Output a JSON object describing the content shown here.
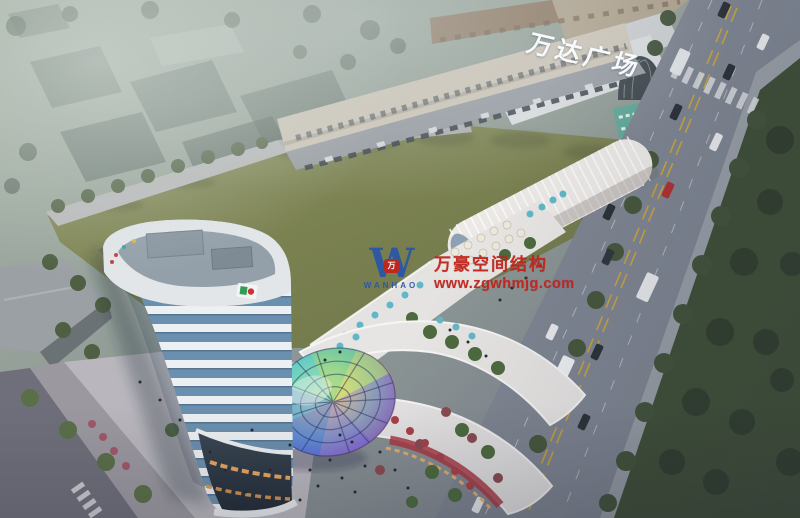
{
  "scene": {
    "description": "Dusk aerial architectural rendering of a mixed-use commercial complex beside Wanda Plaza",
    "mall_sign": {
      "text": "万达广场"
    },
    "watermark": {
      "logo_letter": "W",
      "logo_badge": "万",
      "logo_caption": "WANHAO",
      "line1": "万豪空间结构",
      "line2": "www.zgwhmjg.com"
    },
    "colors": {
      "wm_red": "#c0241c",
      "wm_blue": "#2b57a7",
      "field_green": "#7b8252",
      "road_gray": "#7e8591",
      "park_green": "#3e4e36",
      "tower_glass": "#6b8fae",
      "building_white": "#e8e7e5",
      "warm_light": "#e8a55e",
      "accent_red": "#a83742",
      "umbrella_teal": "#5fb8c8",
      "wanda_roof_brown": "#8f7a64"
    }
  }
}
